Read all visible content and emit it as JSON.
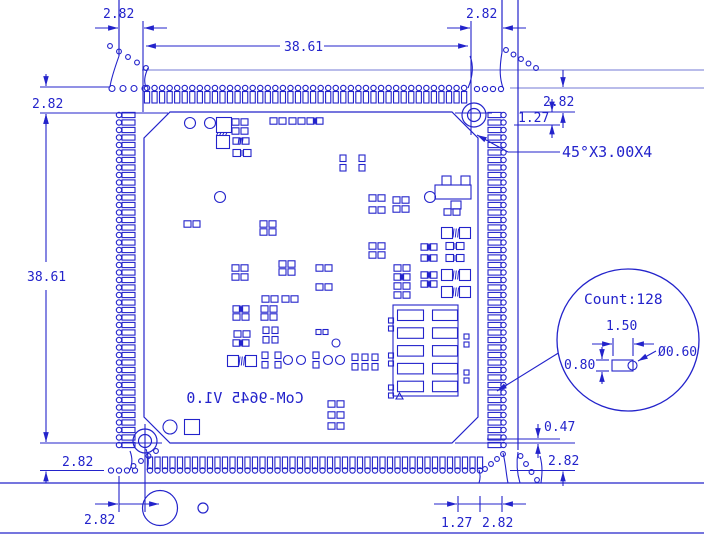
{
  "drawing": {
    "colors": {
      "ink": "#2323cb",
      "pale": "#8f94de",
      "bg": "#ffffff"
    },
    "board": {
      "title_mirrored": "CoM-9645 V1.0"
    },
    "detail_bubble": {
      "count": "Count:128",
      "pad_length": "1.50",
      "pad_width": "0.80",
      "hole_diameter": "Ø0.60"
    },
    "dim_labels": {
      "top_left_offset": "2.82",
      "top_span": "38.61",
      "top_right_offset": "2.82",
      "right_offset": "2.82",
      "right_pitch": "1.27",
      "chamfer_note": "45°X3.00X4",
      "left_top_offset": "2.82",
      "left_span": "38.61",
      "left_bottom_offset": "2.82",
      "bottom_left_offset": "2.82",
      "bottom_pitch": "1.27",
      "bottom_tab_width": "2.82",
      "edge_clearance": "0.47",
      "bottom_right_offset": "2.82"
    },
    "pad_rows": [
      {
        "name": "top",
        "n": 43,
        "start": 147,
        "pitch": 7.55
      },
      {
        "name": "bottom",
        "n": 45,
        "start": 150,
        "pitch": 7.5
      },
      {
        "name": "left",
        "n": 45,
        "start": 115,
        "pitch": 7.5
      },
      {
        "name": "right",
        "n": 45,
        "start": 115,
        "pitch": 7.5
      }
    ],
    "mouse_bites": [
      {
        "x": 110,
        "y": 46,
        "dx": 9,
        "dy": 5.5,
        "n": 5,
        "r": 2.4
      },
      {
        "x": 112,
        "y": 88.5,
        "dx": 11,
        "dy": 0,
        "n": 4,
        "r": 3.0
      },
      {
        "x": 477,
        "y": 89,
        "dx": 8,
        "dy": 0,
        "n": 4,
        "r": 2.6
      },
      {
        "x": 506,
        "y": 50,
        "dx": 7.5,
        "dy": 4.5,
        "n": 5,
        "r": 2.4
      },
      {
        "x": 111,
        "y": 470.5,
        "dx": 8,
        "dy": 0,
        "n": 4,
        "r": 2.6
      },
      {
        "x": 156,
        "y": 451,
        "dx": -7.5,
        "dy": 5,
        "n": 4,
        "r": 2.4
      },
      {
        "x": 485,
        "y": 469,
        "dx": 6,
        "dy": -5,
        "n": 4,
        "r": 2.4
      },
      {
        "x": 520.5,
        "y": 456,
        "dx": 5.5,
        "dy": 8,
        "n": 4,
        "r": 2.4
      }
    ],
    "components": [
      [
        "c",
        190,
        123,
        5.5
      ],
      [
        "c",
        210,
        123,
        5.5
      ],
      [
        "sq",
        224,
        125,
        15
      ],
      [
        "hat",
        224,
        134,
        0
      ],
      [
        "sq",
        223,
        142,
        13
      ],
      [
        "p",
        240,
        122,
        0
      ],
      [
        "p",
        240,
        131,
        0
      ],
      [
        "ph",
        241,
        141,
        0
      ],
      [
        "pb",
        242,
        153,
        0
      ],
      [
        "p",
        278,
        121,
        0
      ],
      [
        "p",
        297,
        121,
        0
      ],
      [
        "pm",
        315,
        121,
        0
      ],
      [
        "pv",
        343,
        163,
        0
      ],
      [
        "pv",
        362,
        163,
        0
      ],
      [
        "c",
        220,
        197,
        5.5
      ],
      [
        "p",
        192,
        224,
        0
      ],
      [
        "p",
        268,
        224,
        0
      ],
      [
        "p",
        268,
        232,
        0
      ],
      [
        "p",
        377,
        198,
        0
      ],
      [
        "p",
        377,
        210,
        0
      ],
      [
        "p",
        401,
        200,
        0
      ],
      [
        "p",
        401,
        209,
        0
      ],
      [
        "c",
        430,
        197,
        5.5
      ],
      [
        "x",
        452,
        188,
        0
      ],
      [
        "p",
        452,
        212,
        0
      ],
      [
        "pm",
        429,
        247,
        0
      ],
      [
        "pm",
        429,
        258,
        0
      ],
      [
        "pb",
        455,
        246,
        0
      ],
      [
        "pb",
        455,
        258,
        0
      ],
      [
        "PH",
        456,
        233,
        0
      ],
      [
        "p",
        377,
        246,
        0
      ],
      [
        "p",
        377,
        255,
        0
      ],
      [
        "p",
        240,
        268,
        0
      ],
      [
        "p",
        240,
        277,
        0
      ],
      [
        "p",
        287,
        264,
        0
      ],
      [
        "p",
        287,
        272,
        0
      ],
      [
        "p",
        324,
        268,
        0
      ],
      [
        "p",
        324,
        287,
        0
      ],
      [
        "p",
        270,
        299,
        0
      ],
      [
        "p",
        290,
        299,
        0
      ],
      [
        "pm",
        241,
        309,
        0
      ],
      [
        "p",
        241,
        317,
        0
      ],
      [
        "p",
        269,
        309,
        0
      ],
      [
        "p",
        269,
        317,
        0
      ],
      [
        "p",
        242,
        334,
        0
      ],
      [
        "pm",
        241,
        343,
        0
      ],
      [
        "pv",
        266,
        335,
        0
      ],
      [
        "pv",
        275,
        335,
        0
      ],
      [
        "sp",
        322,
        332,
        0
      ],
      [
        "c",
        336,
        343,
        4
      ],
      [
        "PH",
        242,
        361,
        0
      ],
      [
        "pv",
        265,
        360,
        0
      ],
      [
        "pv",
        278,
        360,
        0
      ],
      [
        "c",
        288,
        360,
        4.5
      ],
      [
        "c",
        301,
        360,
        4.5
      ],
      [
        "pv",
        316,
        360,
        0
      ],
      [
        "c",
        328,
        360,
        4.5
      ],
      [
        "c",
        340,
        360,
        4.5
      ],
      [
        "pv",
        355,
        362,
        0
      ],
      [
        "pv",
        365,
        362,
        0
      ],
      [
        "pv",
        375,
        362,
        0
      ],
      [
        "p",
        402,
        268,
        0
      ],
      [
        "pm",
        402,
        277,
        0
      ],
      [
        "p",
        402,
        286,
        0
      ],
      [
        "p",
        402,
        295,
        0
      ],
      [
        "pm",
        429,
        275,
        0
      ],
      [
        "pm",
        429,
        284,
        0
      ],
      [
        "PH",
        456,
        275,
        0
      ],
      [
        "PH",
        456,
        292,
        0
      ],
      [
        "p",
        336,
        404,
        0
      ],
      [
        "p",
        336,
        415,
        0
      ],
      [
        "p",
        336,
        426,
        0
      ],
      [
        "c",
        170,
        427,
        7
      ],
      [
        "sq",
        192,
        427,
        15
      ],
      [
        "conn",
        393,
        305,
        0
      ]
    ]
  }
}
